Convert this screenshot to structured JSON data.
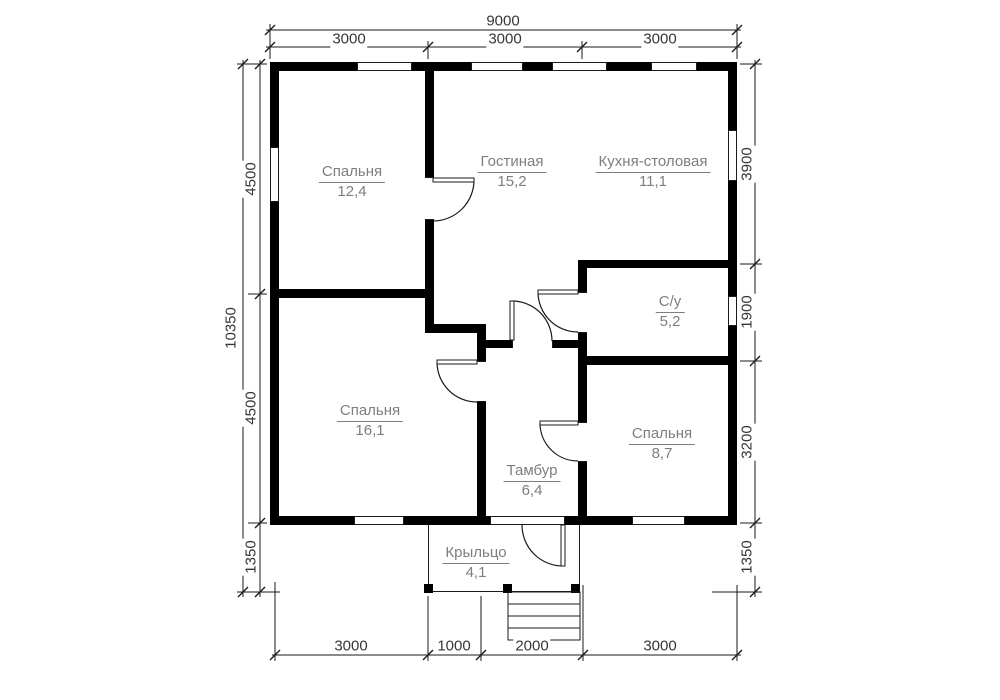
{
  "rooms": [
    {
      "name": "Спальня",
      "area": "12,4"
    },
    {
      "name": "Гостиная",
      "area": "15,2"
    },
    {
      "name": "Кухня-столовая",
      "area": "11,1"
    },
    {
      "name": "С/у",
      "area": "5,2"
    },
    {
      "name": "Спальня",
      "area": "16,1"
    },
    {
      "name": "Спальня",
      "area": "8,7"
    },
    {
      "name": "Тамбур",
      "area": "6,4"
    },
    {
      "name": "Крыльцо",
      "area": "4,1"
    }
  ],
  "dimensions": {
    "top_total": "9000",
    "top_segments": [
      "3000",
      "3000",
      "3000"
    ],
    "left_total": "10350",
    "left_segments": [
      "4500",
      "4500",
      "1350"
    ],
    "right_segments": [
      "3900",
      "1900",
      "3200",
      "1350"
    ],
    "bottom_segments": [
      "3000",
      "1000",
      "2000",
      "3000"
    ]
  },
  "colors": {
    "wall_fill": "#000000",
    "line_work": "#1a1a1a",
    "room_label_text": "#7e7e7e",
    "dimension_text": "#363636",
    "background": "#ffffff"
  }
}
